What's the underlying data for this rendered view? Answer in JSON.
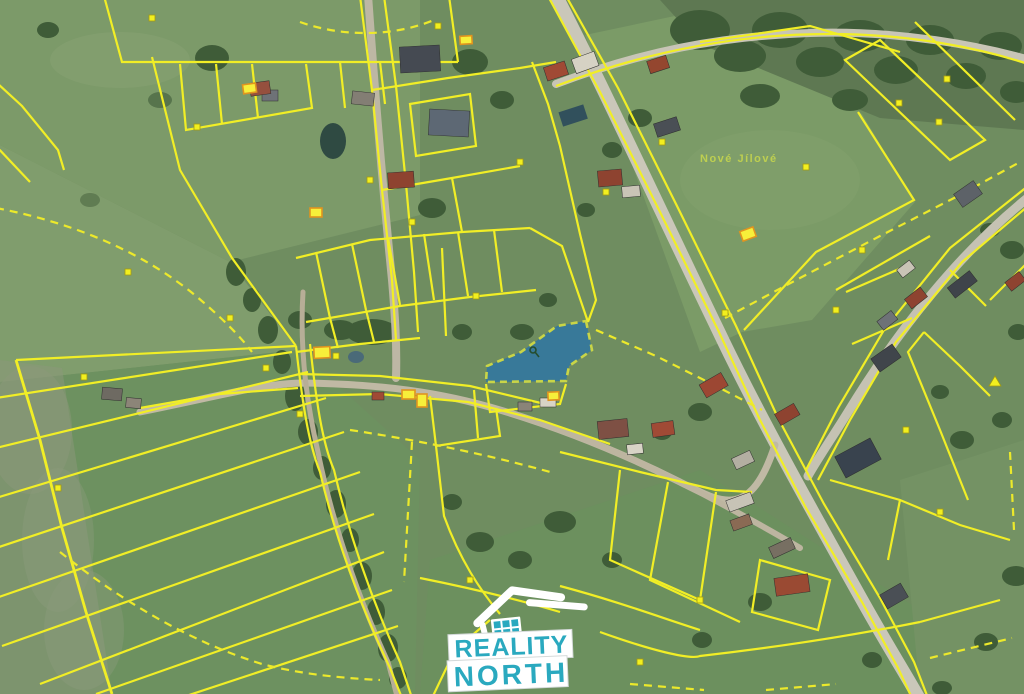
{
  "map": {
    "place_label": "Nové Jílové",
    "cadastral_line_color": "#f1ee26",
    "highlighted_parcel": {
      "fill_color": "#2f76a3",
      "border_color": "#d9e243"
    }
  },
  "watermark": {
    "line1": "REALITY",
    "line2": "NORTH",
    "text_color": "#2aa9bf",
    "panel_color": "#ffffff"
  }
}
